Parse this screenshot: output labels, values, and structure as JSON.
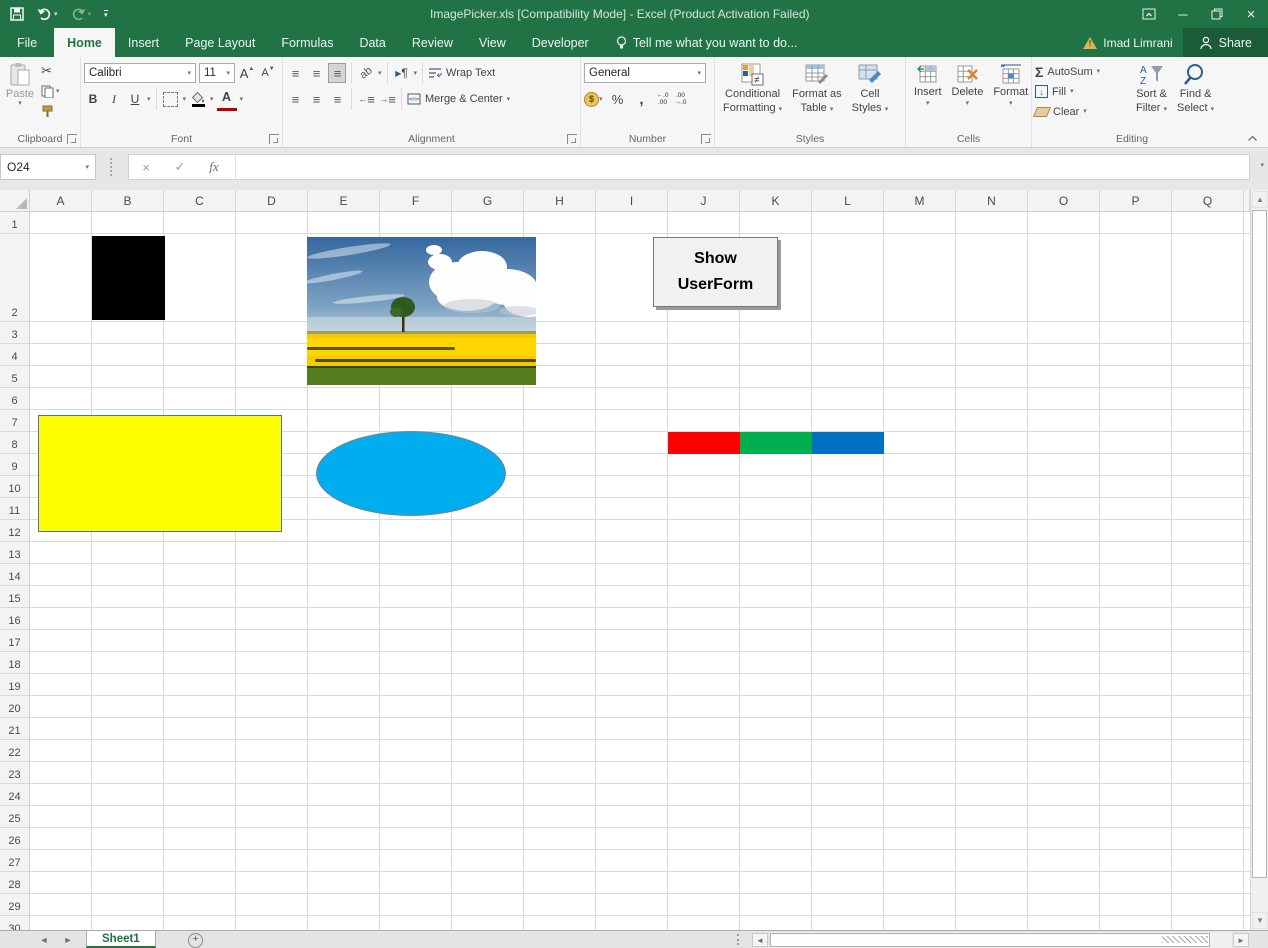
{
  "titlebar": {
    "title": "ImagePicker.xls [Compatibility Mode] - Excel (Product Activation Failed)"
  },
  "tabs": {
    "file": "File",
    "items": [
      "Home",
      "Insert",
      "Page Layout",
      "Formulas",
      "Data",
      "Review",
      "View",
      "Developer"
    ],
    "active": "Home",
    "tell_me": "Tell me what you want to do...",
    "account": "Imad Limrani",
    "share": "Share"
  },
  "ribbon": {
    "clipboard": {
      "label": "Clipboard",
      "paste": "Paste"
    },
    "font": {
      "label": "Font",
      "family": "Calibri",
      "size": "11",
      "bold": "B",
      "italic": "I",
      "underline": "U",
      "grow": "A",
      "shrink": "A",
      "color_letter": "A"
    },
    "alignment": {
      "label": "Alignment",
      "wrap": "Wrap Text",
      "merge": "Merge & Center",
      "orientation": "ab",
      "direction": "¶"
    },
    "number": {
      "label": "Number",
      "format": "General",
      "currency": "$",
      "percent": "%",
      "comma": ",",
      "inc_top": "←.0",
      "inc_bot": ".00",
      "dec_top": ".00",
      "dec_bot": "→.0"
    },
    "styles": {
      "label": "Styles",
      "conditional_1": "Conditional",
      "conditional_2": "Formatting",
      "table_1": "Format as",
      "table_2": "Table",
      "cell_1": "Cell",
      "cell_2": "Styles"
    },
    "cells": {
      "label": "Cells",
      "insert": "Insert",
      "delete": "Delete",
      "format": "Format"
    },
    "editing": {
      "label": "Editing",
      "sigma": "Σ",
      "autosum": "AutoSum",
      "fill": "Fill",
      "clear": "Clear",
      "sort_1": "Sort &",
      "sort_2": "Filter",
      "find_1": "Find &",
      "find_2": "Select",
      "sort_a": "A",
      "sort_z": "Z"
    }
  },
  "formula_bar": {
    "name_box": "O24",
    "cancel": "×",
    "enter": "✓",
    "fx": "fx",
    "value": ""
  },
  "sheet": {
    "columns": [
      "A",
      "B",
      "C",
      "D",
      "E",
      "F",
      "G",
      "H",
      "I",
      "J",
      "K",
      "L",
      "M",
      "N",
      "O",
      "P",
      "Q"
    ],
    "row_count": 30,
    "objects": {
      "userform_button": "Show UserForm",
      "image": "landscape-photo-tree-in-yellow-field",
      "colors": {
        "excel_green": "#217346",
        "black_box": "#000000",
        "yellow_rect": "#ffff00",
        "yellow_rect_border": "#4472c4",
        "ellipse": "#00aeef",
        "ellipse_border": "#7f7f7f",
        "cell_red": "#ff0000",
        "cell_green": "#00b050",
        "cell_blue": "#0070c0"
      }
    }
  },
  "tab_bar": {
    "sheet": "Sheet1",
    "new_sheet": "+"
  }
}
